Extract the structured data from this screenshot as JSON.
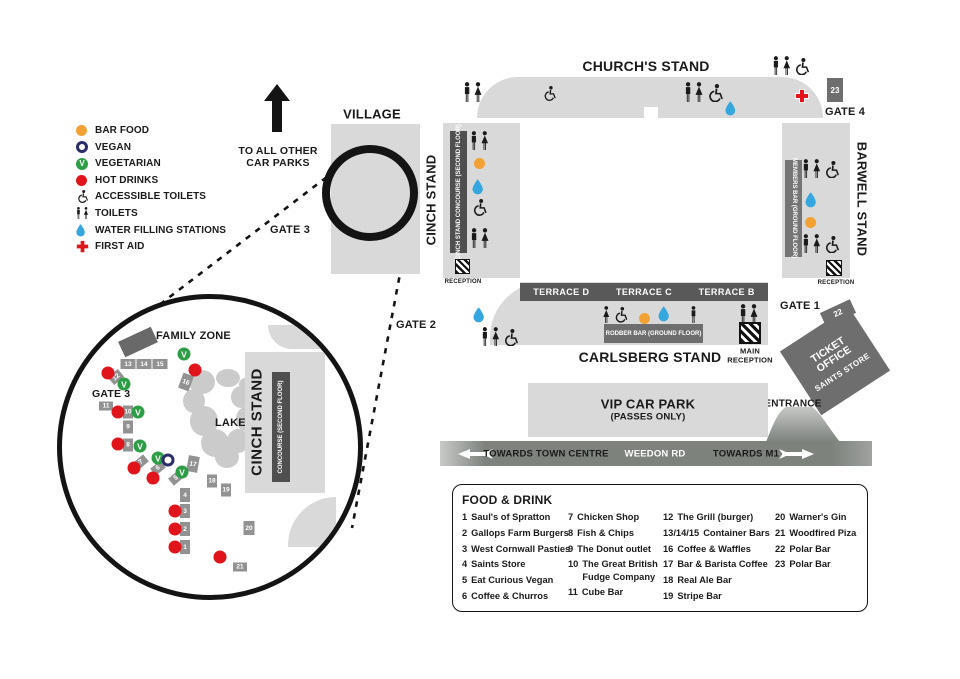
{
  "colors": {
    "stand": "#d9d9d9",
    "bar_dark": "#4f4f4f",
    "bar_mid": "#6e6e6e",
    "box_gray": "#929292",
    "terrace": "#595959",
    "road": "#7d827d",
    "black": "#1a1a1a",
    "orange": "#f2a235",
    "red": "#e0151b",
    "green": "#2e9e46",
    "blue": "#35a7de",
    "navy": "#2b2d6b"
  },
  "legend": {
    "items": [
      {
        "id": "bar-food",
        "type": "dot",
        "color": "#f2a235",
        "label": "BAR FOOD"
      },
      {
        "id": "vegan",
        "type": "ring",
        "label": "VEGAN"
      },
      {
        "id": "vegetarian",
        "type": "v-badge",
        "label": "VEGETARIAN"
      },
      {
        "id": "hot-drinks",
        "type": "dot",
        "color": "#e0151b",
        "label": "HOT DRINKS"
      },
      {
        "id": "accessible-toilets",
        "type": "wc",
        "label": "ACCESSIBLE TOILETS"
      },
      {
        "id": "toilets",
        "type": "toilets",
        "label": "TOILETS"
      },
      {
        "id": "water-filling-stations",
        "type": "drop",
        "label": "WATER FILLING STATIONS"
      },
      {
        "id": "first-aid",
        "type": "cross",
        "label": "FIRST AID"
      }
    ]
  },
  "map": {
    "village": "VILLAGE",
    "to_car_parks": "TO ALL OTHER CAR PARKS",
    "gates": {
      "g1": "GATE 1",
      "g2": "GATE 2",
      "g3": "GATE 3",
      "g4": "GATE 4"
    },
    "stands": {
      "churchs": "CHURCH'S STAND",
      "cinch": "CINCH STAND",
      "cinch_bar": "CINCH STAND CONCOURSE (SECOND FLOOR)",
      "barwell": "BARWELL STAND",
      "barwell_bar": "MEMBERS BAR (GROUND FLOOR)",
      "carlsberg": "CARLSBERG STAND",
      "carlsberg_bar": "RODBER BAR (GROUND FLOOR)",
      "terraces": [
        "TERRACE D",
        "TERRACE C",
        "TERRACE B"
      ]
    },
    "reception": "RECEPTION",
    "main_reception": "MAIN RECEPTION",
    "ticket_office": [
      "TICKET OFFICE",
      "SAINTS STORE"
    ],
    "entrance": "ENTRANCE",
    "vip": [
      "VIP CAR PARK",
      "(PASSES ONLY)"
    ],
    "road": {
      "left": "TOWARDS TOWN CENTRE",
      "center": "WEEDON RD",
      "right": "TOWARDS M1"
    },
    "boxes": [
      {
        "n": "23",
        "x": 835,
        "y": 90,
        "w": 16,
        "h": 24,
        "r": 0
      },
      {
        "n": "22",
        "x": 838,
        "y": 313,
        "w": 33,
        "h": 15,
        "r": -25
      }
    ],
    "icons": [
      {
        "t": "toilets",
        "x": 463,
        "y": 82,
        "h": 20
      },
      {
        "t": "wc",
        "x": 542,
        "y": 86,
        "h": 15
      },
      {
        "t": "toilets-wc",
        "x": 684,
        "y": 82,
        "h": 20
      },
      {
        "t": "drop",
        "x": 725,
        "y": 101,
        "h": 15
      },
      {
        "t": "cross",
        "x": 795,
        "y": 89,
        "h": 14
      },
      {
        "t": "toilets-wc",
        "x": 772,
        "y": 56,
        "h": 19
      },
      {
        "t": "toilets",
        "x": 470,
        "y": 131,
        "h": 19
      },
      {
        "t": "dot",
        "x": 474,
        "y": 156,
        "h": 11
      },
      {
        "t": "drop",
        "x": 472,
        "y": 179,
        "h": 16
      },
      {
        "t": "wc",
        "x": 471,
        "y": 199,
        "h": 17
      },
      {
        "t": "toilets",
        "x": 470,
        "y": 228,
        "h": 20
      },
      {
        "t": "toilets-wc",
        "x": 802,
        "y": 159,
        "h": 19
      },
      {
        "t": "drop",
        "x": 805,
        "y": 192,
        "h": 16
      },
      {
        "t": "dot",
        "x": 805,
        "y": 215,
        "h": 11
      },
      {
        "t": "toilets-wc",
        "x": 802,
        "y": 234,
        "h": 19
      },
      {
        "t": "drop",
        "x": 473,
        "y": 307,
        "h": 16
      },
      {
        "t": "toilets-wc",
        "x": 481,
        "y": 327,
        "h": 19
      },
      {
        "t": "woman-wc",
        "x": 602,
        "y": 306,
        "h": 17
      },
      {
        "t": "dot",
        "x": 639,
        "y": 311,
        "h": 11
      },
      {
        "t": "drop",
        "x": 658,
        "y": 306,
        "h": 16
      },
      {
        "t": "man",
        "x": 690,
        "y": 306,
        "h": 17
      },
      {
        "t": "toilets",
        "x": 739,
        "y": 304,
        "h": 20
      }
    ]
  },
  "zoom_circle": {
    "family_zone": "FAMILY ZONE",
    "gate3": "GATE 3",
    "lake": "LAKE",
    "cinch": "CINCH STAND",
    "cinch_bar": "CONCOURSE (SECOND FLOOR)",
    "boxes": [
      {
        "n": "13",
        "x": 128,
        "y": 364,
        "w": 15,
        "h": 10,
        "r": 0
      },
      {
        "n": "14",
        "x": 144,
        "y": 364,
        "w": 15,
        "h": 10,
        "r": 0
      },
      {
        "n": "15",
        "x": 160,
        "y": 364,
        "w": 15,
        "h": 10,
        "r": 0
      },
      {
        "n": "12",
        "x": 116,
        "y": 377,
        "w": 13,
        "h": 10,
        "r": -40
      },
      {
        "n": "16",
        "x": 186,
        "y": 382,
        "w": 11,
        "h": 16,
        "r": 20
      },
      {
        "n": "11",
        "x": 106,
        "y": 406,
        "w": 14,
        "h": 9,
        "r": 0
      },
      {
        "n": "10",
        "x": 128,
        "y": 412,
        "w": 10,
        "h": 13,
        "r": 0
      },
      {
        "n": "9",
        "x": 128,
        "y": 427,
        "w": 10,
        "h": 13,
        "r": 0
      },
      {
        "n": "8",
        "x": 128,
        "y": 445,
        "w": 10,
        "h": 13,
        "r": 0
      },
      {
        "n": "7",
        "x": 141,
        "y": 462,
        "w": 13,
        "h": 9,
        "r": -40
      },
      {
        "n": "6",
        "x": 158,
        "y": 468,
        "w": 13,
        "h": 9,
        "r": -40
      },
      {
        "n": "5",
        "x": 176,
        "y": 478,
        "w": 13,
        "h": 9,
        "r": -40
      },
      {
        "n": "4",
        "x": 185,
        "y": 495,
        "w": 10,
        "h": 14,
        "r": 0
      },
      {
        "n": "3",
        "x": 185,
        "y": 511,
        "w": 10,
        "h": 14,
        "r": 0
      },
      {
        "n": "2",
        "x": 185,
        "y": 529,
        "w": 10,
        "h": 14,
        "r": 0
      },
      {
        "n": "1",
        "x": 185,
        "y": 547,
        "w": 10,
        "h": 14,
        "r": 0
      },
      {
        "n": "17",
        "x": 193,
        "y": 464,
        "w": 11,
        "h": 16,
        "r": 10
      },
      {
        "n": "18",
        "x": 212,
        "y": 481,
        "w": 10,
        "h": 13,
        "r": 0
      },
      {
        "n": "19",
        "x": 226,
        "y": 490,
        "w": 10,
        "h": 13,
        "r": 0
      },
      {
        "n": "20",
        "x": 249,
        "y": 528,
        "w": 11,
        "h": 14,
        "r": 0
      },
      {
        "n": "21",
        "x": 240,
        "y": 567,
        "w": 14,
        "h": 9,
        "r": 0
      }
    ],
    "red_dots": [
      [
        108,
        373
      ],
      [
        195,
        370
      ],
      [
        118,
        412
      ],
      [
        118,
        444
      ],
      [
        134,
        468
      ],
      [
        153,
        478
      ],
      [
        175,
        511
      ],
      [
        175,
        529
      ],
      [
        175,
        547
      ],
      [
        220,
        557
      ]
    ],
    "v_badges": [
      [
        184,
        354
      ],
      [
        124,
        384
      ],
      [
        138,
        412
      ],
      [
        140,
        446
      ],
      [
        158,
        458
      ],
      [
        182,
        472
      ]
    ],
    "vegan_rings": [
      [
        168,
        460
      ]
    ]
  },
  "food_drink": {
    "title": "FOOD & DRINK",
    "columns": [
      [
        {
          "num": "1",
          "name": "Saul's of Spratton"
        },
        {
          "num": "2",
          "name": "Gallops Farm Burgers"
        },
        {
          "num": "3",
          "name": "West Cornwall Pasties"
        },
        {
          "num": "4",
          "name": "Saints Store"
        },
        {
          "num": "5",
          "name": "Eat Curious Vegan"
        },
        {
          "num": "6",
          "name": "Coffee & Churros"
        }
      ],
      [
        {
          "num": "7",
          "name": "Chicken Shop"
        },
        {
          "num": "8",
          "name": "Fish & Chips"
        },
        {
          "num": "9",
          "name": "The Donut outlet"
        },
        {
          "num": "10",
          "name": "The Great British Fudge Company"
        },
        {
          "num": "11",
          "name": "Cube Bar"
        }
      ],
      [
        {
          "num": "12",
          "name": "The Grill (burger)"
        },
        {
          "num": "13/14/15",
          "name": "Container Bars"
        },
        {
          "num": "16",
          "name": "Coffee & Waffles"
        },
        {
          "num": "17",
          "name": "Bar & Barista Coffee"
        },
        {
          "num": "18",
          "name": "Real Ale Bar"
        },
        {
          "num": "19",
          "name": "Stripe Bar"
        }
      ],
      [
        {
          "num": "20",
          "name": "Warner's Gin"
        },
        {
          "num": "21",
          "name": "Woodfired Piza"
        },
        {
          "num": "22",
          "name": "Polar Bar"
        },
        {
          "num": "23",
          "name": "Polar Bar"
        }
      ]
    ]
  }
}
